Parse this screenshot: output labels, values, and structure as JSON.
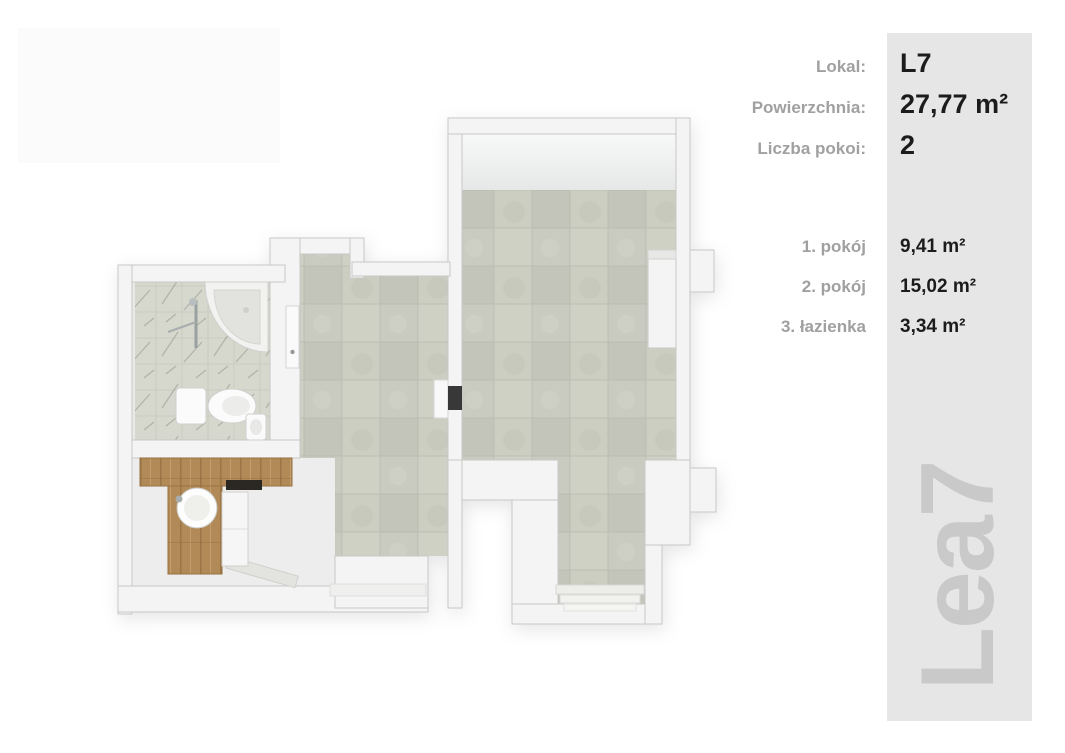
{
  "panel": {
    "background": "#e6e6e6",
    "watermark": "Lea7",
    "info": [
      {
        "label": "Lokal:",
        "value": "L7"
      },
      {
        "label": "Powierzchnia:",
        "value": "27,77 m²"
      },
      {
        "label": "Liczba pokoi:",
        "value": "2"
      }
    ],
    "rooms": [
      {
        "label": "1. pokój",
        "value": "9,41 m²"
      },
      {
        "label": "2. pokój",
        "value": "15,02 m²"
      },
      {
        "label": "3. łazienka",
        "value": "3,34 m²"
      }
    ]
  },
  "floorplan": {
    "type": "3d-top-down-apartment-render",
    "rooms": [
      "pokój 1",
      "pokój 2",
      "łazienka",
      "korytarz"
    ],
    "colors": {
      "wall": "#f4f4f4",
      "tile_floor": "#c9cbc0",
      "marble_floor": "#d6d8ce",
      "wood": "#b28a58",
      "plain_floor": "#ecedec",
      "door_gap": "#383838"
    }
  },
  "colors": {
    "page_background": "#ffffff",
    "label_gray": "#a0a0a0",
    "value_dark": "#1c1c1c",
    "watermark_gray": "#c9c9c9"
  }
}
